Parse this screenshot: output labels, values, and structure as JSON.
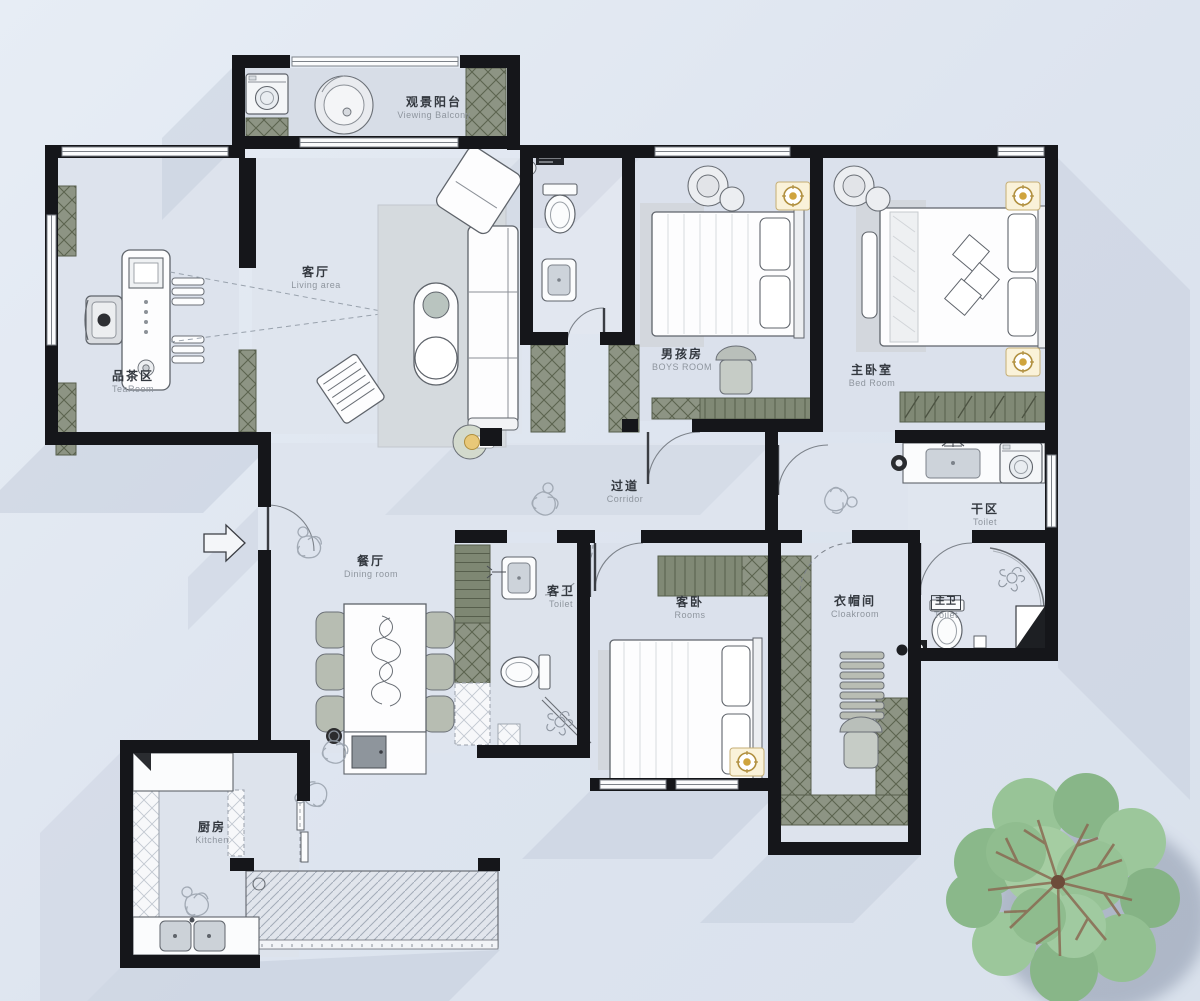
{
  "plan": {
    "rooms": {
      "viewing_balcony": {
        "zh": "观景阳台",
        "en": "Viewing Balcony"
      },
      "living": {
        "zh": "客厅",
        "en": "Living area"
      },
      "tea": {
        "zh": "品茶区",
        "en": "TeaRoom"
      },
      "boys": {
        "zh": "男孩房",
        "en": "BOYS ROOM"
      },
      "master": {
        "zh": "主卧室",
        "en": "Bed Room"
      },
      "corridor": {
        "zh": "过道",
        "en": "Corridor"
      },
      "dry_area": {
        "zh": "干区",
        "en": "Toilet"
      },
      "dining": {
        "zh": "餐厅",
        "en": "Dining room"
      },
      "guest_toilet": {
        "zh": "客卫",
        "en": "Toilet"
      },
      "guest_bedroom": {
        "zh": "客卧",
        "en": "Rooms"
      },
      "cloakroom": {
        "zh": "衣帽间",
        "en": "Cloakroom"
      },
      "master_toilet": {
        "zh": "主卫",
        "en": "Toilet"
      },
      "kitchen": {
        "zh": "厨房",
        "en": "Kitchen"
      }
    },
    "colors": {
      "wall": "#15161a",
      "cabinet_green": "#8d9484",
      "cabinet_green_dark": "#5c634f",
      "accent_gold": "#cfa43e",
      "floor": "#dde3ec",
      "shadow": "#bfc8d7",
      "tree_green": "#8ab88a",
      "background": "#dfe6f0"
    }
  }
}
